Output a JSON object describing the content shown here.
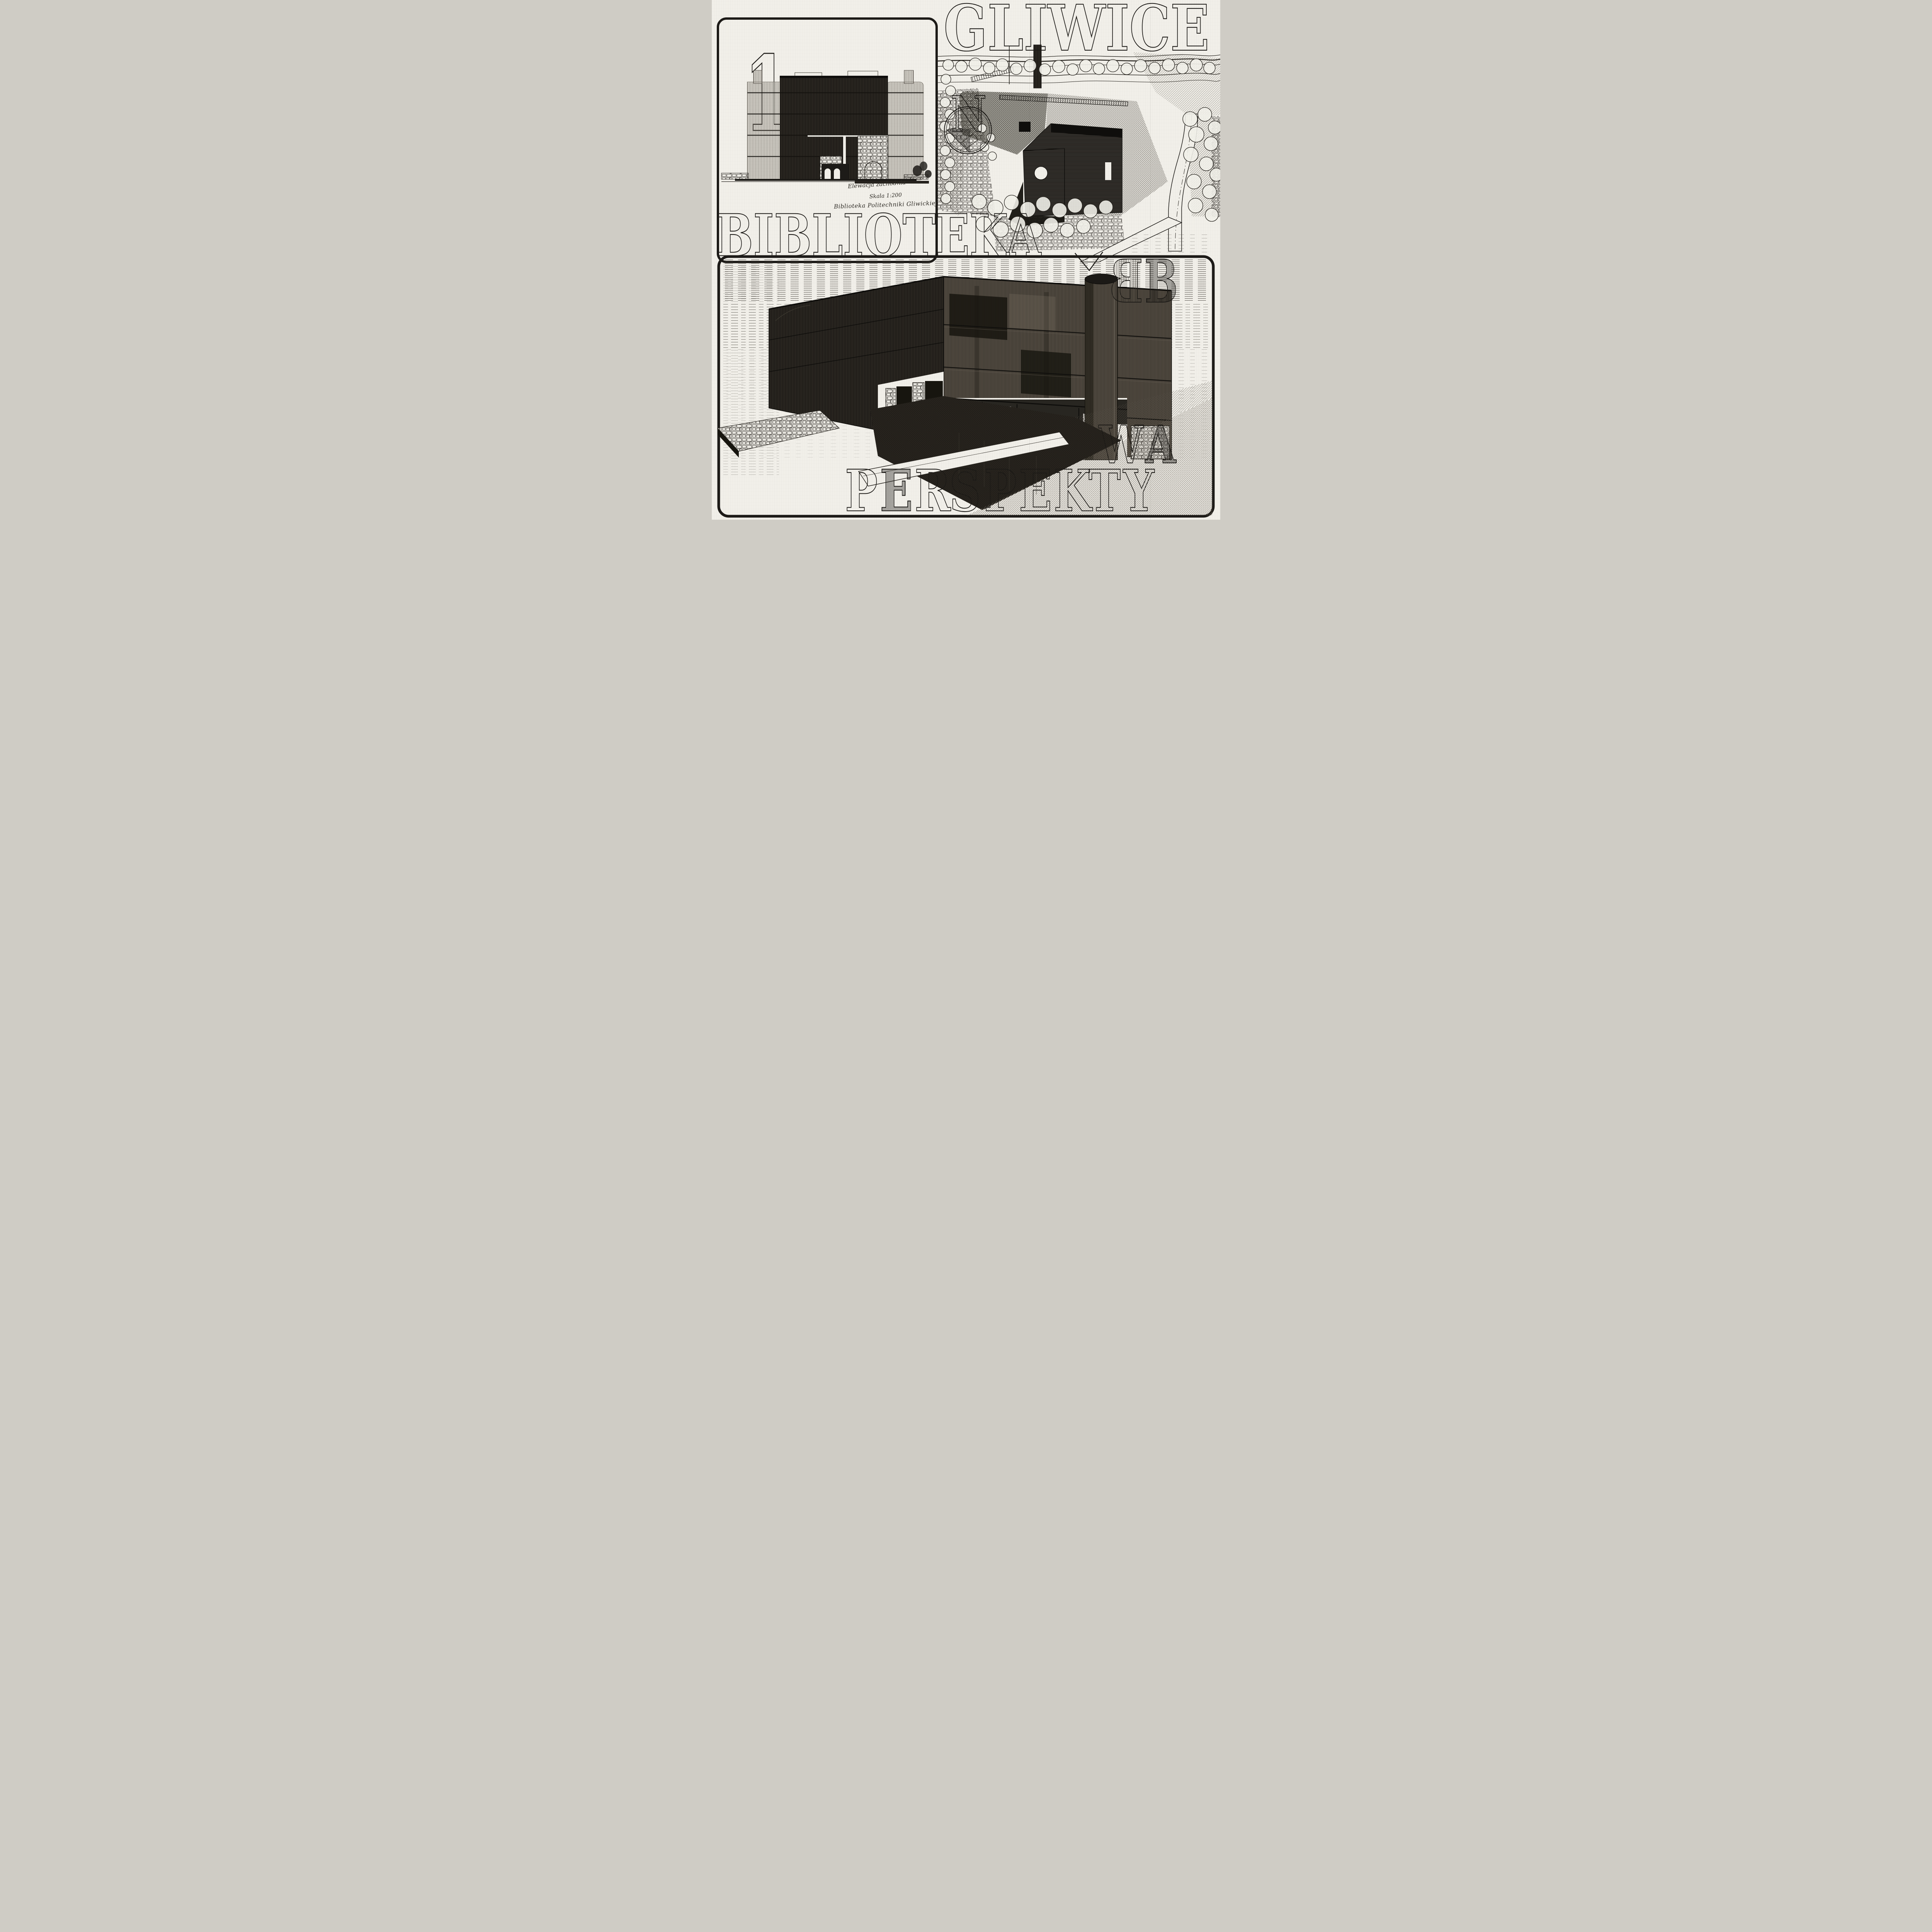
{
  "poster": {
    "paper_color": "#f1efe9",
    "ink_color": "#1c1a17",
    "elevation_panel": {
      "number": "1",
      "caption_line1": "Elewacja zachodnia",
      "caption_line2": "Skala 1:200",
      "caption_line3": "Biblioteka Politechniki Gliwickiej"
    },
    "site_plan": {
      "city_title": "GLIWICE",
      "north_letter": "N"
    },
    "middle_title": "BIBLIOTEKA",
    "monogram_letter": "B",
    "perspective_panel": {
      "bottom_title_letters": [
        "P",
        "E",
        "R",
        "S",
        "P",
        "E",
        "K",
        "T",
        "Y"
      ],
      "suffix_letters": [
        "W",
        "A"
      ]
    }
  }
}
